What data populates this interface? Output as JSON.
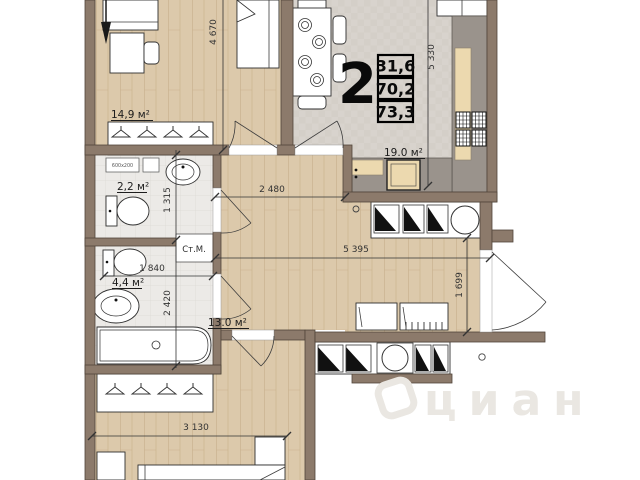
{
  "floorplan": {
    "unit_spec": {
      "rooms_count": "2",
      "values": [
        "31,6",
        "70,2",
        "73,3"
      ]
    },
    "room_labels": {
      "bedroom_top": "14,9 м²",
      "wc": "2,2 м²",
      "bathroom": "4,4 м²",
      "hallway": "13.0 м²",
      "kitchen_living": "19.0 м²"
    },
    "annotations": {
      "washing_machine": "Ст.М.",
      "vent_size": "600x200"
    },
    "dimensions": {
      "v_left": "4 670",
      "v_right": "5 330",
      "v_wc": "1 315",
      "v_bath": "2 420",
      "v_entry": "1 699",
      "h_hall_top": "2 480",
      "h_hall_main": "5 395",
      "h_bath": "1 840",
      "h_bedroom_bottom": "3 130"
    },
    "watermark": {
      "brand": "циан"
    },
    "colors": {
      "wall": "#8c7a6b",
      "wood_floor": "#dcc9ab",
      "living_floor": "#d8d3cd",
      "tile_floor": "#eceae7",
      "counter_gray": "#9a938c",
      "counter_beige": "#ecd9af",
      "watermark": "#eae7e2"
    }
  }
}
